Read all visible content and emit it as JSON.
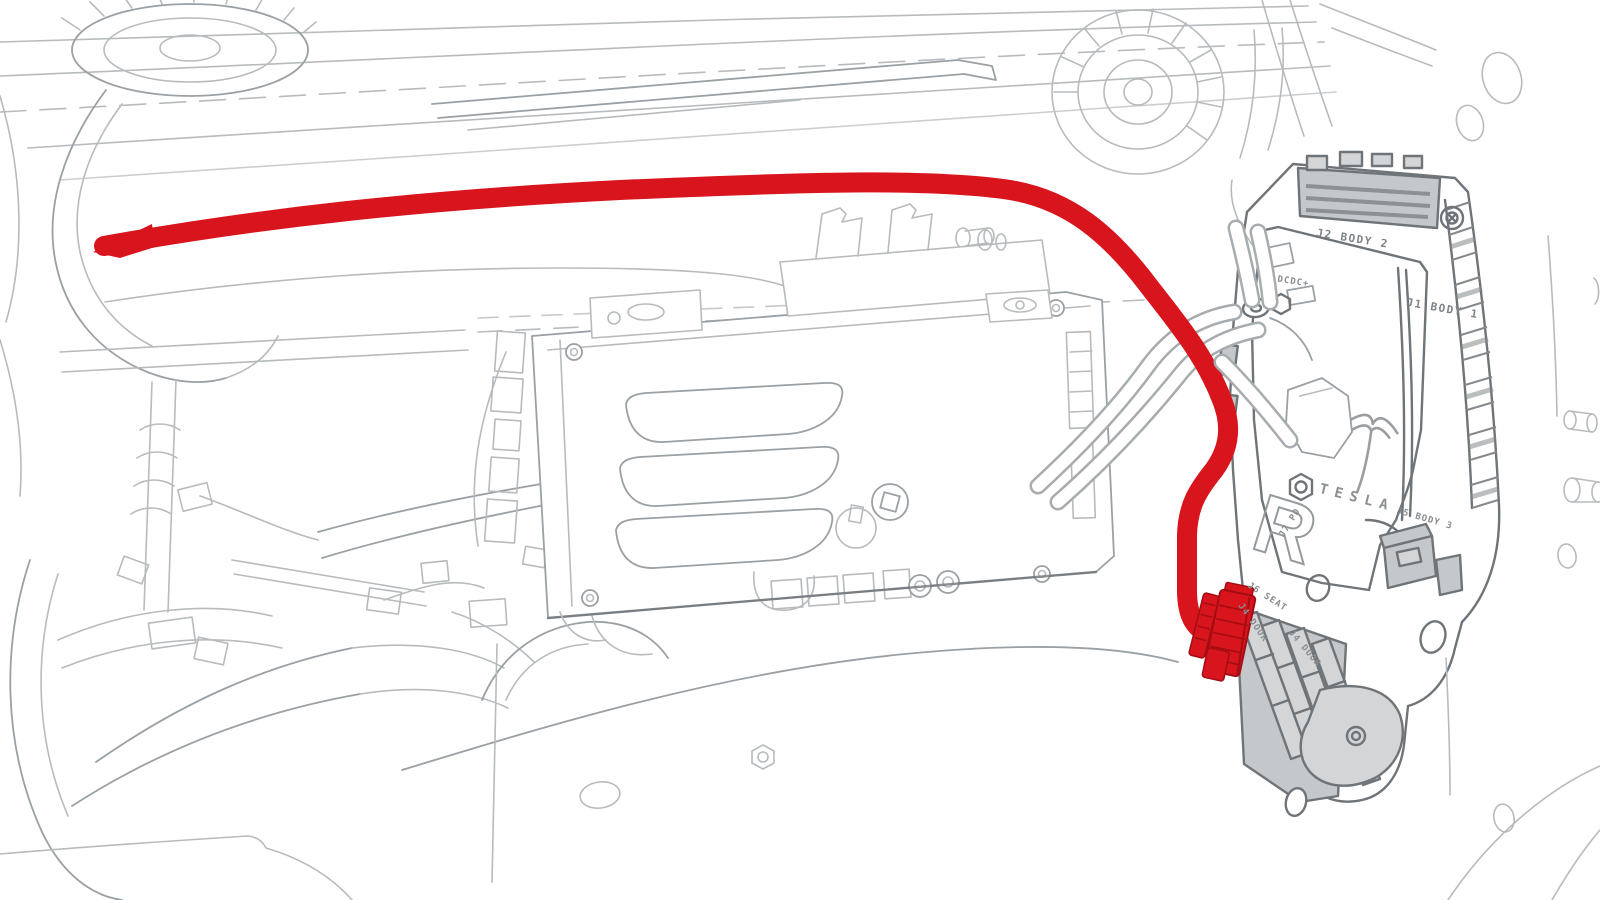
{
  "illustration": {
    "title": "Front compartment harness routing to right body controller",
    "style": "service-manual-line-art"
  },
  "colors": {
    "background": "#ffffff",
    "line_light": "#b7bbbd",
    "line_mid": "#9aa0a3",
    "line_dark": "#6f7478",
    "module_fill": "#d3d5d6",
    "module_fill_dark": "#c5c8ca",
    "highlight_red": "#d8141c",
    "highlight_red_dark": "#a30d13"
  },
  "module": {
    "brand": "TESLA",
    "marking_r": "R",
    "labels": {
      "j2_body_2": "J2 BODY 2",
      "j1_body_1": "J1 BODY 1",
      "dcdc": "DCDC+",
      "j7_pd": "J7 PD",
      "j5_body_3": "J5 BODY 3",
      "j6_seat": "J6 SEAT",
      "j4_door_small": "J4 DOOR",
      "j4_door": "J4 DOOR"
    }
  }
}
